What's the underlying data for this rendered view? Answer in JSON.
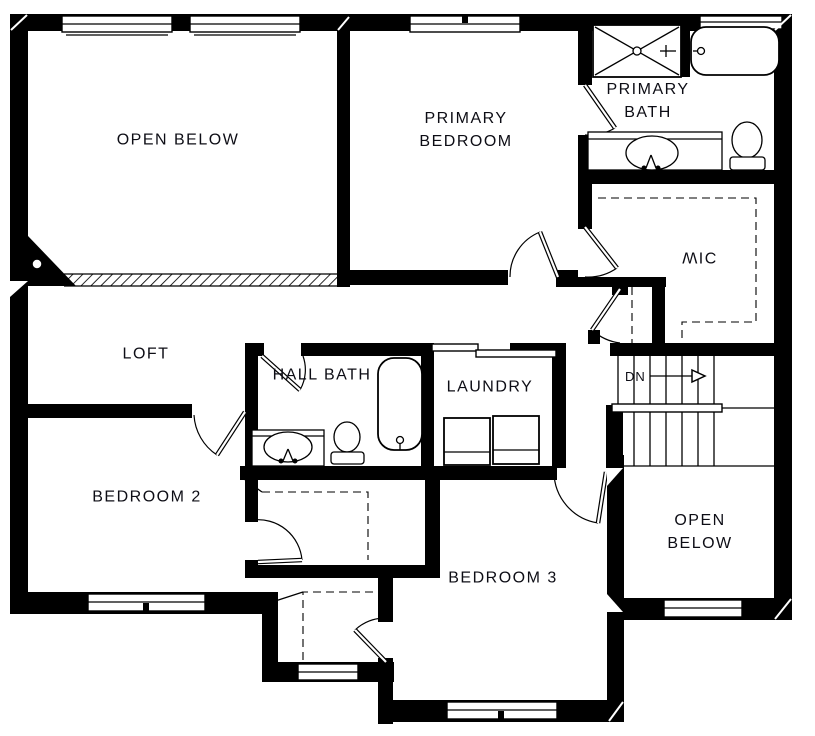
{
  "colors": {
    "wall": "#000000",
    "background": "#ffffff",
    "text": "#0d0d15"
  },
  "labels": {
    "open_below_upper": "OPEN BELOW",
    "primary_bedroom": "PRIMARY\nBEDROOM",
    "primary_bath": "PRIMARY\nBATH",
    "wic": "WIC",
    "loft": "LOFT",
    "hall_bath": "HALL BATH",
    "laundry": "LAUNDRY",
    "bedroom_2": "BEDROOM 2",
    "bedroom_3": "BEDROOM 3",
    "open_below_lower": "OPEN BELOW",
    "stairs_down": "DN"
  }
}
